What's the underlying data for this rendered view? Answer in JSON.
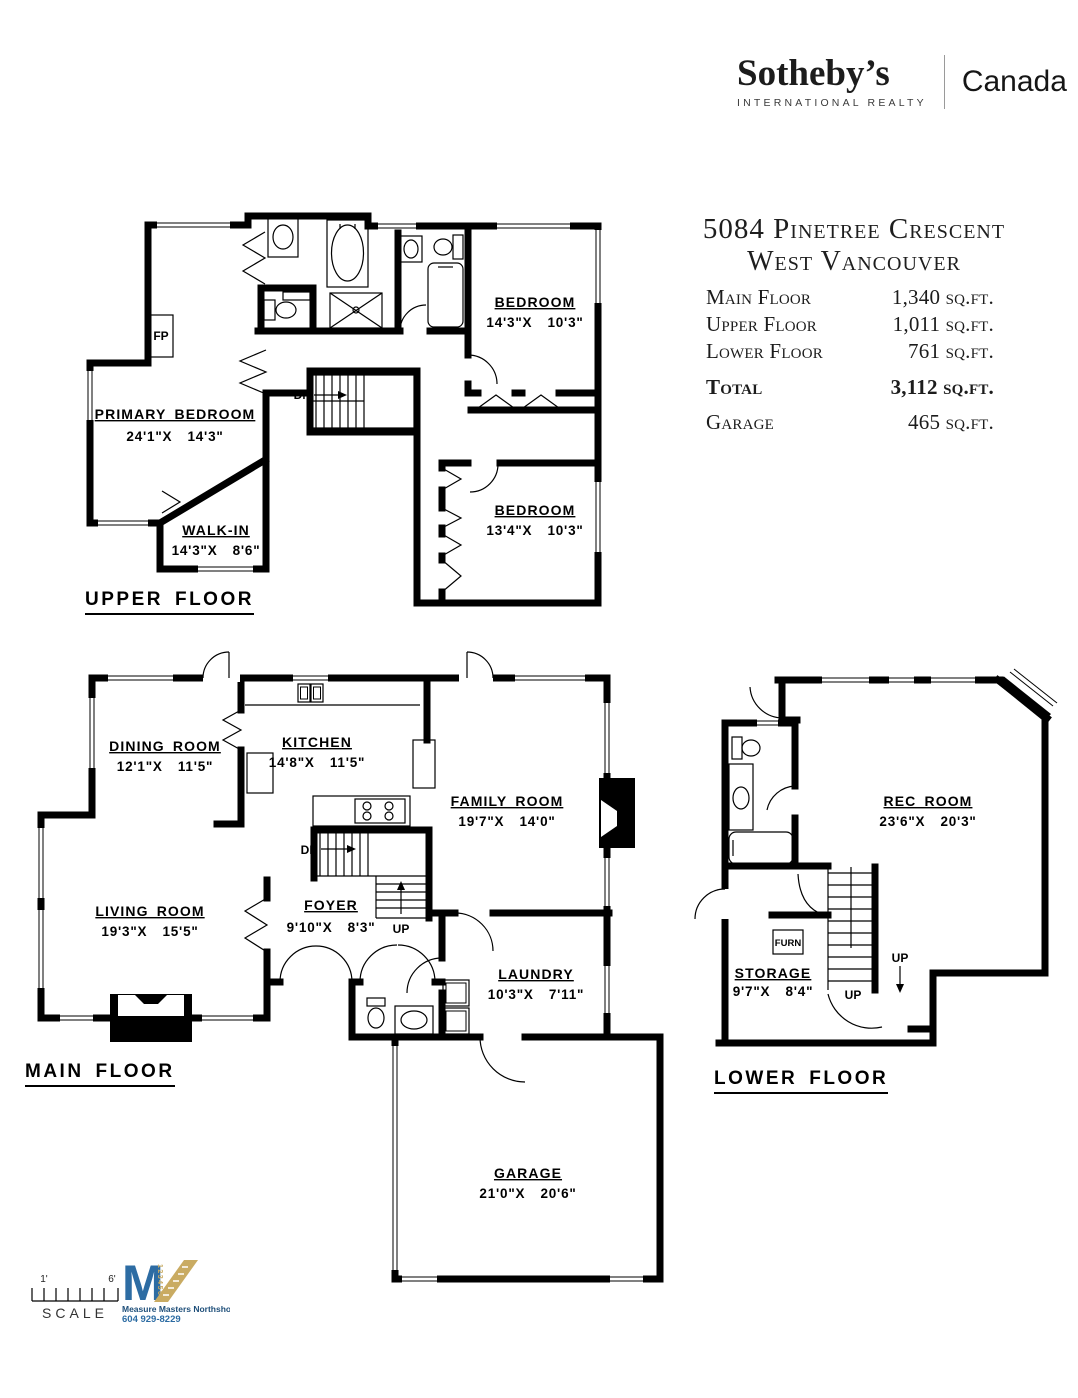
{
  "header": {
    "brand": "Sotheby’s",
    "brand_sub": "INTERNATIONAL REALTY",
    "region": "Canada"
  },
  "summary": {
    "address1": "5084 Pinetree Crescent",
    "address2": "West Vancouver",
    "rows": [
      {
        "label": "Main Floor",
        "value": "1,340",
        "unit": "sq.ft."
      },
      {
        "label": "Upper Floor",
        "value": "1,011",
        "unit": "sq.ft."
      },
      {
        "label": "Lower Floor",
        "value": "761",
        "unit": "sq.ft."
      },
      {
        "label": "Total",
        "value": "3,112",
        "unit": "sq.ft."
      },
      {
        "label": "Garage",
        "value": "465",
        "unit": "sq.ft."
      }
    ]
  },
  "upper": {
    "title": "UPPER FLOOR",
    "primary": {
      "name": "PRIMARY BEDROOM",
      "dims": "24'1\"X  14'3\""
    },
    "bedroom1": {
      "name": "BEDROOM",
      "dims": "14'3\"X  10'3\""
    },
    "bedroom2": {
      "name": "BEDROOM",
      "dims": "13'4\"X  10'3\""
    },
    "walkin": {
      "name": "WALK-IN",
      "dims": "14'3\"X  8'6\""
    },
    "fp": "FP",
    "dn": "DN"
  },
  "main": {
    "title": "MAIN FLOOR",
    "dining": {
      "name": "DINING ROOM",
      "dims": "12'1\"X  11'5\""
    },
    "kitchen": {
      "name": "KITCHEN",
      "dims": "14'8\"X  11'5\""
    },
    "family": {
      "name": "FAMILY ROOM",
      "dims": "19'7\"X  14'0\""
    },
    "living": {
      "name": "LIVING ROOM",
      "dims": "19'3\"X  15'5\""
    },
    "foyer": {
      "name": "FOYER",
      "dims": "9'10\"X  8'3\""
    },
    "laundry": {
      "name": "LAUNDRY",
      "dims": "10'3\"X  7'11\""
    },
    "garage": {
      "name": "GARAGE",
      "dims": "21'0\"X  20'6\""
    },
    "dn": "DN",
    "up": "UP"
  },
  "lower": {
    "title": "LOWER FLOOR",
    "rec": {
      "name": "REC ROOM",
      "dims": "23'6\"X  20'3\""
    },
    "storage": {
      "name": "STORAGE",
      "dims": "9'7\"X  8'4\""
    },
    "furn": "FURN",
    "up_stairs": "UP",
    "up_entry": "UP"
  },
  "footer": {
    "scale_left": "1'",
    "scale_right": "6'",
    "scale_label": "SCALE",
    "mm_monogram": "M",
    "mm_ruler_numbers": "123456",
    "surveyor_name": "Measure Masters Northshore",
    "surveyor_phone": "604 929-8229"
  },
  "colors": {
    "wall": "#000000",
    "logo_blue": "#2d6ca3",
    "logo_tan": "#c9ab62"
  }
}
